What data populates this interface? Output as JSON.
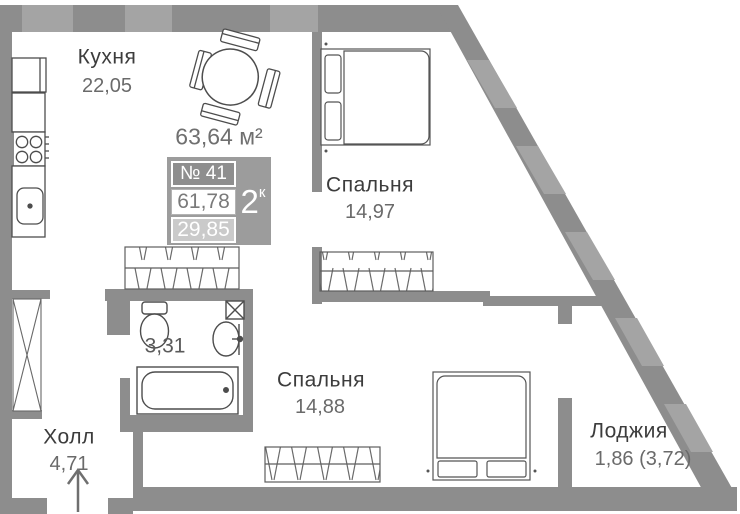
{
  "plan_title": "apartment floor plan",
  "total_area": "63,64 м²",
  "unit_badge": {
    "number": "№ 41",
    "rooms": "2",
    "rooms_suffix": "к",
    "area_main": "61,78",
    "area_secondary": "29,85"
  },
  "rooms": {
    "kitchen": {
      "name": "Кухня",
      "area": "22,05"
    },
    "bedroom1": {
      "name": "Спальня",
      "area": "14,97"
    },
    "bedroom2": {
      "name": "Спальня",
      "area": "14,88"
    },
    "bathroom": {
      "area": "3,31"
    },
    "hall": {
      "name": "Холл",
      "area": "4,71"
    },
    "loggia": {
      "name": "Лоджия",
      "area": "1,86 (3,72)"
    }
  },
  "colors": {
    "wall": "#8d8d8d",
    "wall_window": "#a4a4a4",
    "badge_bg": "#9c9c9c",
    "badge_number_bg": "#8e8e8e",
    "badge_secondary_bg": "#cacaca",
    "room_name_text": "#3c3c3c",
    "room_area_text": "#6a6a6a"
  }
}
